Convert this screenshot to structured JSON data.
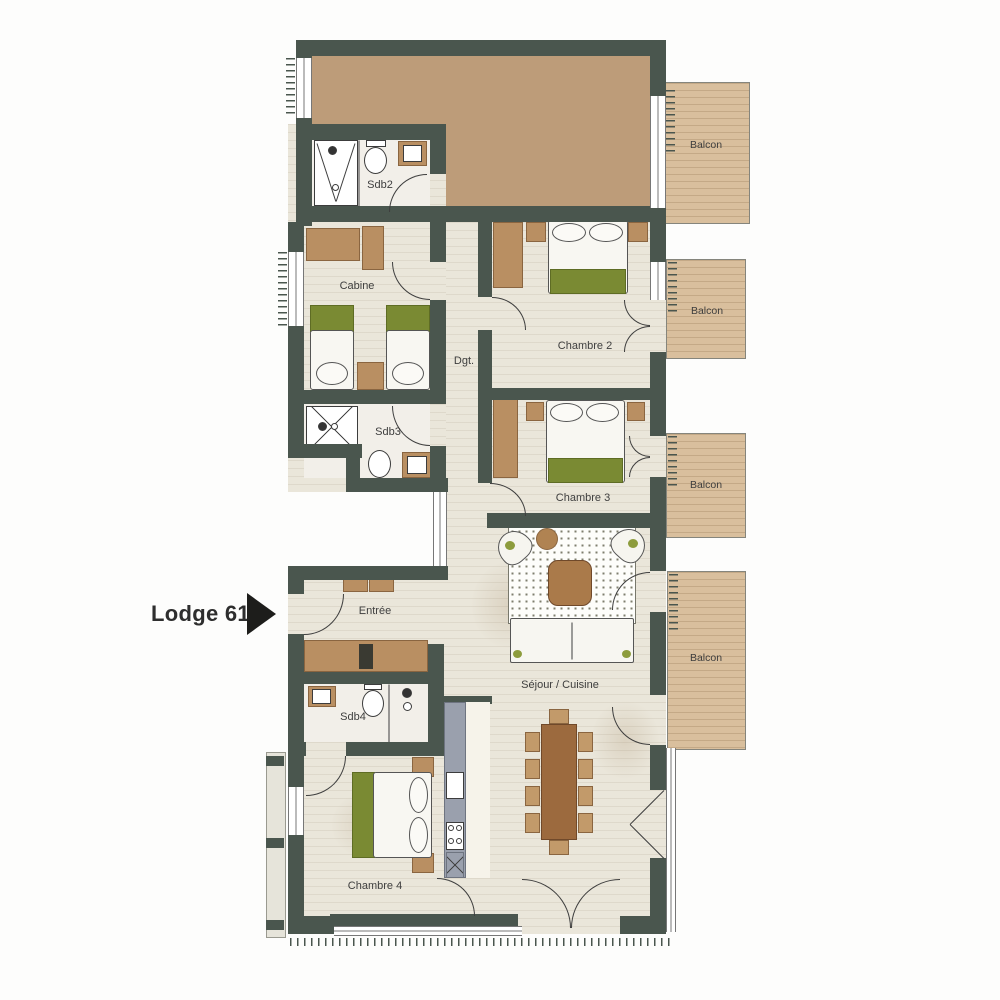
{
  "title": {
    "label": "Lodge 61"
  },
  "plan": {
    "rooms": [
      {
        "id": "sdb2",
        "label": "Sdb2"
      },
      {
        "id": "cabine",
        "label": "Cabine"
      },
      {
        "id": "dgt",
        "label": "Dgt."
      },
      {
        "id": "chambre2",
        "label": "Chambre 2"
      },
      {
        "id": "sdb3",
        "label": "Sdb3"
      },
      {
        "id": "chambre3",
        "label": "Chambre 3"
      },
      {
        "id": "entree",
        "label": "Entrée"
      },
      {
        "id": "sdb4",
        "label": "Sdb4"
      },
      {
        "id": "sejour",
        "label": "Séjour / Cuisine"
      },
      {
        "id": "chambre4",
        "label": "Chambre 4"
      }
    ],
    "balconies": [
      {
        "label": "Balcon"
      },
      {
        "label": "Balcon"
      },
      {
        "label": "Balcon"
      },
      {
        "label": "Balcon"
      }
    ]
  },
  "colors": {
    "wall": "#4a564e",
    "floor": "#eae6da",
    "bath_floor": "#f2efe9",
    "tan_area": "#bd9c79",
    "balcony_wood": "#d9bf9d",
    "bed_green": "#7a8a33",
    "furniture_brown": "#b98f62",
    "table_brown": "#9c6a3e",
    "kitchen_gray": "#9aa0ad",
    "arrow_black": "#1d1d1b"
  }
}
